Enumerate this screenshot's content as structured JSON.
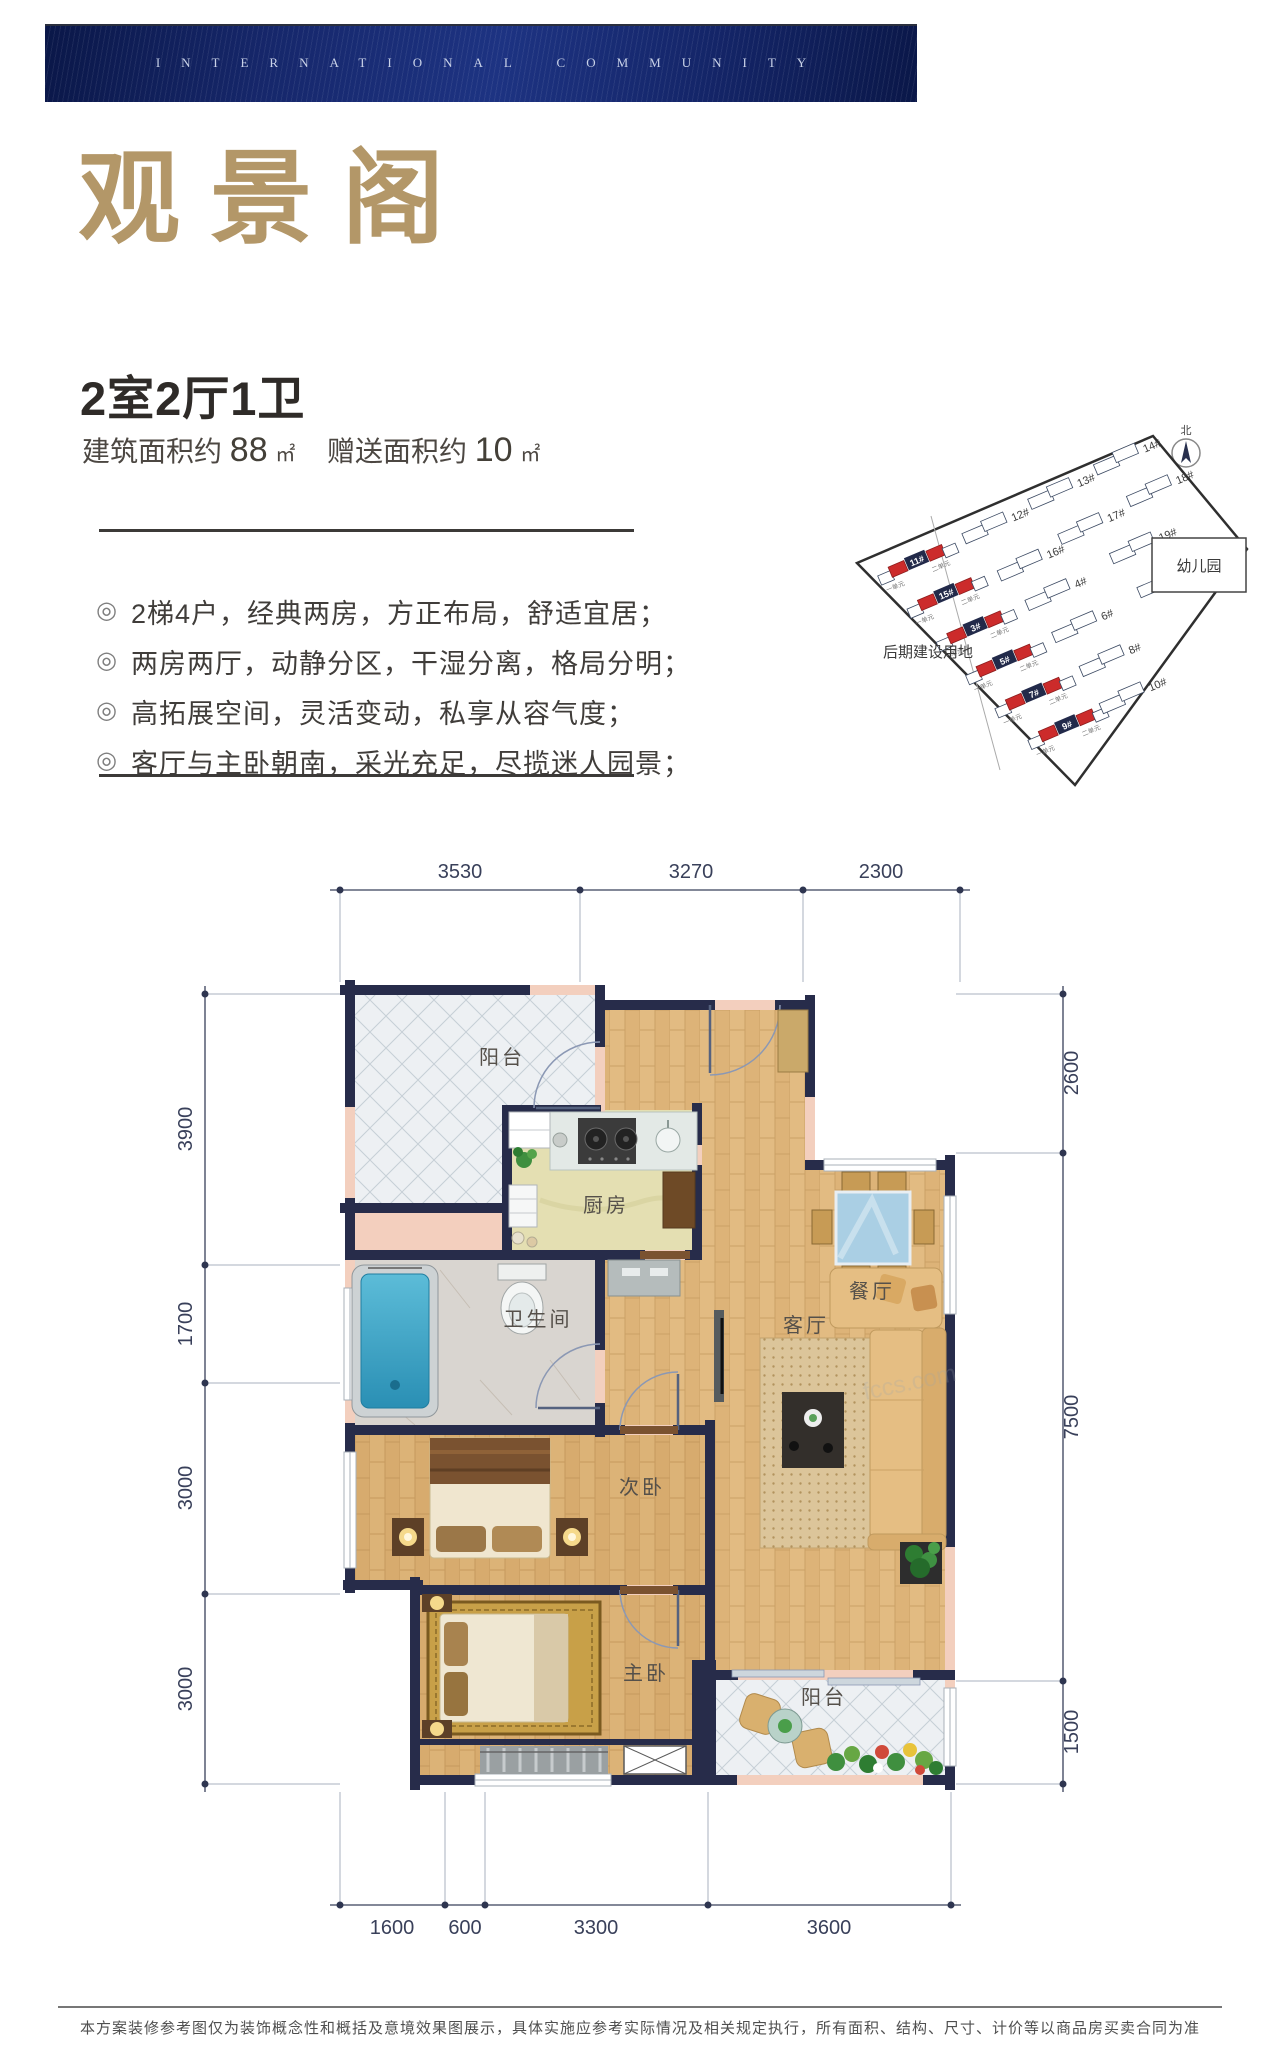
{
  "banner": {
    "text": "INTERNATIONAL COMMUNITY"
  },
  "listing": {
    "name": "观景阁",
    "layout": "2室2厅1卫",
    "area": {
      "build_label": "建筑面积约",
      "build_value": "88",
      "build_unit": "㎡",
      "gift_label": "赠送面积约",
      "gift_value": "10",
      "gift_unit": "㎡"
    },
    "bullet_glyph": "◎",
    "features": [
      "2梯4户，经典两房，方正布局，舒适宜居；",
      "两房两厅，动静分区，干湿分离，格局分明；",
      "高拓展空间，灵活变动，私享从容气度；",
      "客厅与主卧朝南，采光充足，尽揽迷人园景；"
    ]
  },
  "site_plan": {
    "north_label": "北",
    "left_area_label": "后期建设用地",
    "kindergarten_label": "幼儿园",
    "unit_left": "一单元",
    "unit_right": "二单元",
    "buildings": [
      {
        "label": "11#",
        "highlighted": true
      },
      {
        "label": "12#",
        "highlighted": false
      },
      {
        "label": "13#",
        "highlighted": false
      },
      {
        "label": "14#",
        "highlighted": false
      },
      {
        "label": "15#",
        "highlighted": true
      },
      {
        "label": "16#",
        "highlighted": false
      },
      {
        "label": "17#",
        "highlighted": false
      },
      {
        "label": "18#",
        "highlighted": false
      },
      {
        "label": "3#",
        "highlighted": true
      },
      {
        "label": "4#",
        "highlighted": false
      },
      {
        "label": "19#",
        "highlighted": false
      },
      {
        "label": "5#",
        "highlighted": true
      },
      {
        "label": "6#",
        "highlighted": false
      },
      {
        "label": "20#",
        "highlighted": false
      },
      {
        "label": "7#",
        "highlighted": true
      },
      {
        "label": "8#",
        "highlighted": false
      },
      {
        "label": "9#",
        "highlighted": true
      },
      {
        "label": "10#",
        "highlighted": false
      }
    ]
  },
  "floor_plan": {
    "rooms": {
      "balcony_top": "阳台",
      "kitchen": "厨房",
      "bath": "卫生间",
      "second_bed": "次卧",
      "master_bed": "主卧",
      "living": "客厅",
      "dining": "餐厅",
      "balcony_bottom": "阳台"
    },
    "dims": {
      "top": [
        "3530",
        "3270",
        "2300"
      ],
      "left": [
        "3900",
        "1700",
        "3000",
        "3000"
      ],
      "right": [
        "2600",
        "7500",
        "1500"
      ],
      "bottom": [
        "1600",
        "600",
        "3300",
        "3600"
      ]
    },
    "watermark": "fccs.com"
  },
  "footer": {
    "disclaimer": "本方案装修参考图仅为装饰概念性和概括及意境效果图展示，具体实施应参考实际情况及相关规定执行，所有面积、结构、尺寸、计价等以商品房买卖合同为准"
  },
  "colors": {
    "wall_navy": "#272c4a",
    "wall_infill": "#f3cfbe",
    "gold": "#b39768",
    "highlight_red": "#cc2b2b"
  }
}
